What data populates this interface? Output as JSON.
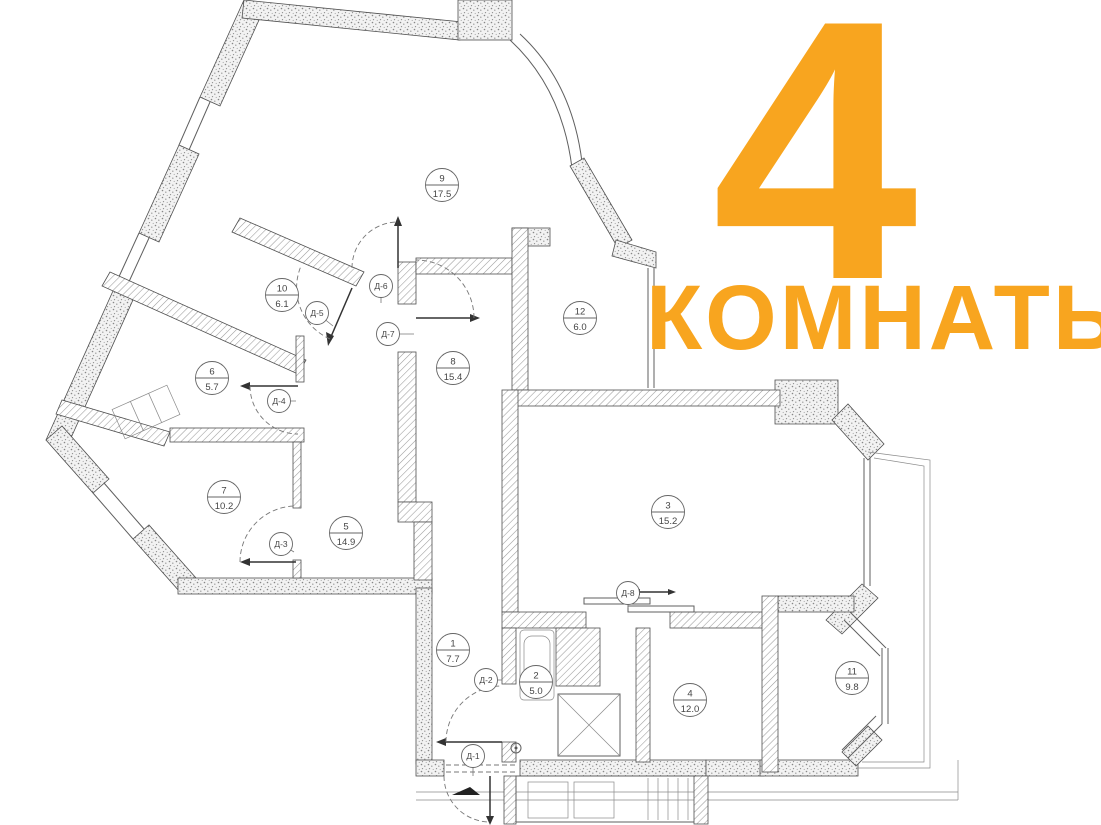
{
  "title": {
    "number": "4",
    "subtitle": "КОМНАТЫ",
    "color": "#F8A51F"
  },
  "plan": {
    "legend": "номер помещения / площадь",
    "rooms": [
      {
        "number": "1",
        "area": "7.7",
        "x": 453,
        "y": 650
      },
      {
        "number": "2",
        "area": "5.0",
        "x": 536,
        "y": 682
      },
      {
        "number": "3",
        "area": "15.2",
        "x": 668,
        "y": 512
      },
      {
        "number": "4",
        "area": "12.0",
        "x": 690,
        "y": 700
      },
      {
        "number": "5",
        "area": "14.9",
        "x": 346,
        "y": 533
      },
      {
        "number": "6",
        "area": "5.7",
        "x": 212,
        "y": 378
      },
      {
        "number": "7",
        "area": "10.2",
        "x": 224,
        "y": 497
      },
      {
        "number": "8",
        "area": "15.4",
        "x": 453,
        "y": 368
      },
      {
        "number": "9",
        "area": "17.5",
        "x": 442,
        "y": 185
      },
      {
        "number": "10",
        "area": "6.1",
        "x": 282,
        "y": 295
      },
      {
        "number": "11",
        "area": "9.8",
        "x": 852,
        "y": 678
      },
      {
        "number": "12",
        "area": "6.0",
        "x": 580,
        "y": 318
      }
    ],
    "doors": [
      {
        "label": "Д-1",
        "x": 473,
        "y": 756,
        "lx": 473,
        "ly": 776
      },
      {
        "label": "Д-2",
        "x": 486,
        "y": 680,
        "lx": 502,
        "ly": 680
      },
      {
        "label": "Д-3",
        "x": 281,
        "y": 544,
        "lx": 294,
        "ly": 552
      },
      {
        "label": "Д-4",
        "x": 279,
        "y": 401,
        "lx": 296,
        "ly": 401
      },
      {
        "label": "Д-5",
        "x": 317,
        "y": 313,
        "lx": 333,
        "ly": 326
      },
      {
        "label": "Д-6",
        "x": 381,
        "y": 286,
        "lx": 381,
        "ly": 303
      },
      {
        "label": "Д-7",
        "x": 388,
        "y": 334,
        "lx": 414,
        "ly": 334
      },
      {
        "label": "Д-8",
        "x": 628,
        "y": 593,
        "lx": 628,
        "ly": 608
      }
    ],
    "wall_colors": {
      "outline": "#4f4f4f",
      "hatch": "#9b9b9b",
      "speckle": "#878787"
    }
  }
}
